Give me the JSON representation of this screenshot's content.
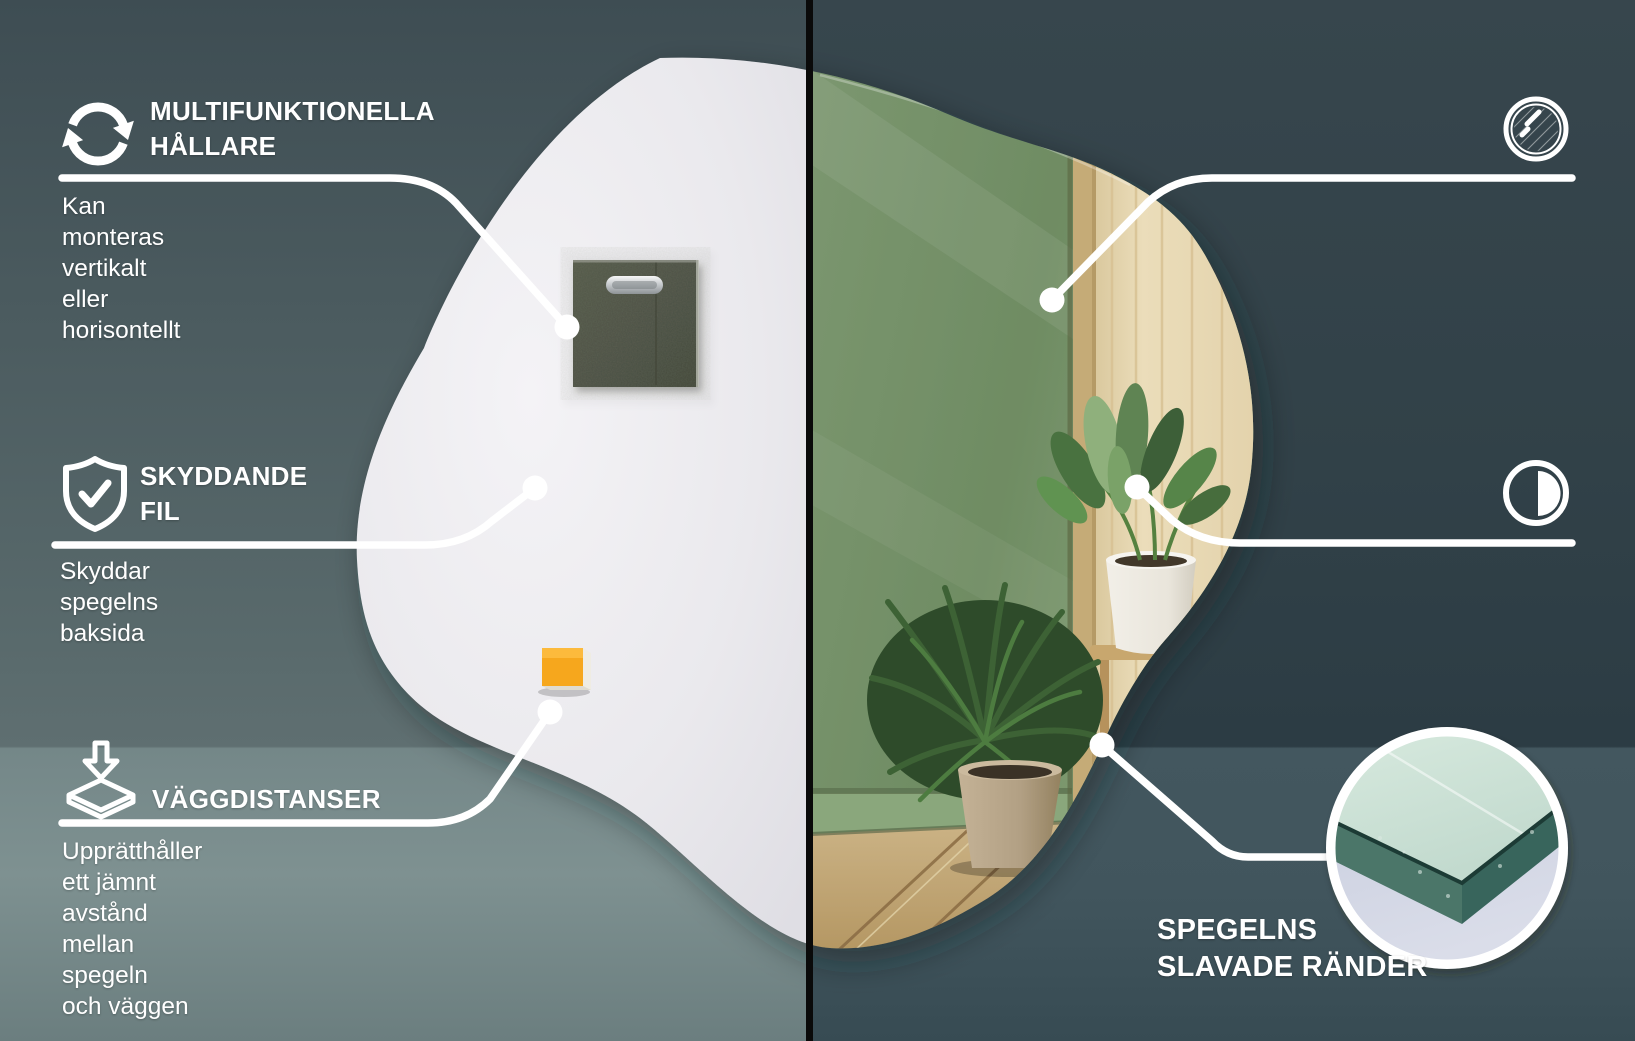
{
  "canvas": {
    "width": 1635,
    "height": 1041
  },
  "colors": {
    "accent_white": "#FFFFFF",
    "divider": "#0A0A0A",
    "left_wall": "#49585C",
    "left_floor": "#738687",
    "right_wall": "#32424A",
    "right_floor": "#42565E",
    "mirror_back": "#EAE9ED",
    "reflection_wall_green": "#7A956D",
    "wood_panel": "#E7D8B4",
    "reflection_floor_wood": "#C9B183",
    "hanger_felt": "#4C5145",
    "spacer_pad_orange": "#F6A71D",
    "glass_edge_teal": "#3F6D60",
    "glass_surface_mint": "#CFE3D8",
    "inset_table_lavender": "#CBD0DF"
  },
  "left_panel": {
    "features": [
      {
        "id": "multifunctional-hangers",
        "icon": "rotate-arrows-icon",
        "title": "MULTIFUNKTIONELLA\nHÅLLARE",
        "description": "Kan monteras vertikalt\neller horisontellt"
      },
      {
        "id": "protective-film",
        "icon": "shield-check-icon",
        "title": "SKYDDANDE\nFIL",
        "description": "Skyddar\nspegelns baksida"
      },
      {
        "id": "wall-spacers",
        "icon": "spacer-stack-icon",
        "title": "VÄGGDISTANSER",
        "description": "Upprätthåller ett jämnt\navstånd mellan spegeln\noch väggen"
      }
    ]
  },
  "right_panel": {
    "features": [
      {
        "id": "top-class-mirror",
        "icon": "mirror-circle-icon",
        "title": "SPEGEL AV\nBÄSTA KLASS",
        "description": "Perfekt slät yta som inte\nförvränger reflektionen"
      },
      {
        "id": "modern-design",
        "icon": "half-circle-icon",
        "title": "MODERN\nDESIGN",
        "description": "Unik form för\nstilfull inredning"
      }
    ],
    "edge_callout": {
      "id": "ground-edges",
      "title": "SPEGELNS\nSLAVADE RÄNDER"
    }
  }
}
